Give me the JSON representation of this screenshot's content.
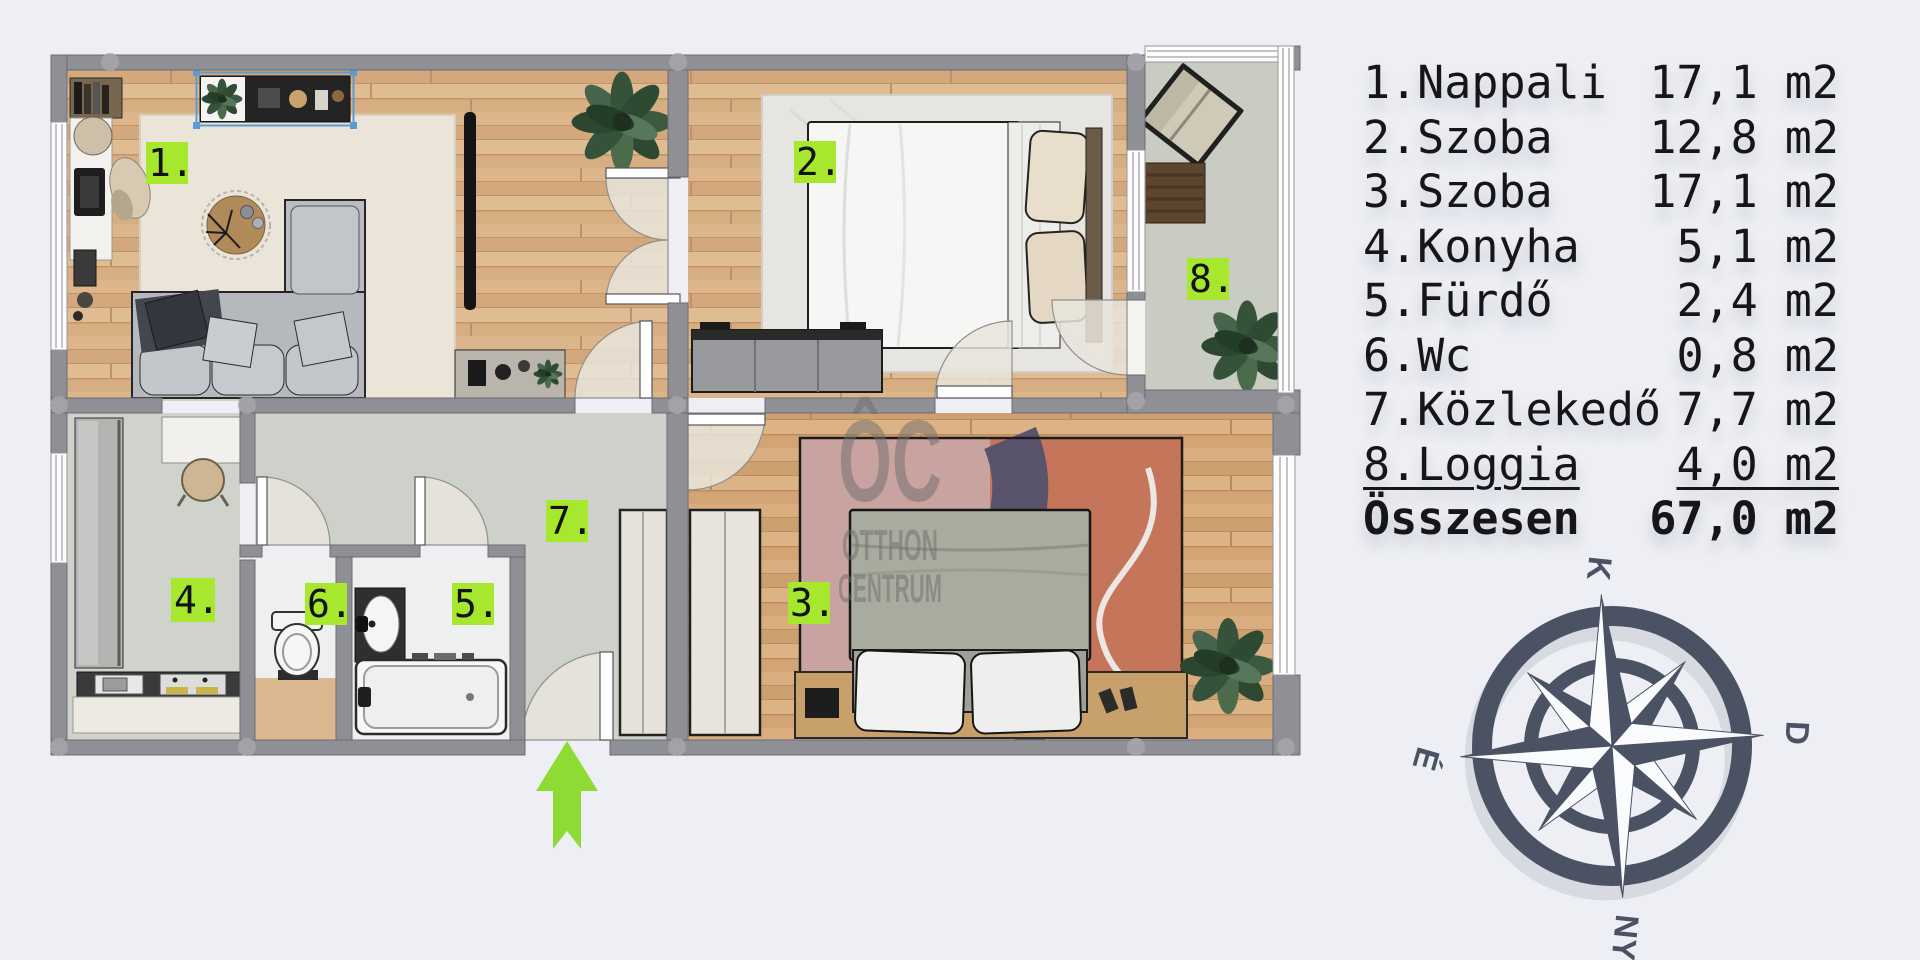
{
  "page": {
    "background": "#edeff4",
    "type": "apartment floor plan"
  },
  "legend": {
    "rows": [
      {
        "name": "1.Nappali",
        "area": "17,1 m2"
      },
      {
        "name": "2.Szoba",
        "area": "12,8 m2"
      },
      {
        "name": "3.Szoba",
        "area": "17,1 m2"
      },
      {
        "name": "4.Konyha",
        "area": "5,1 m2"
      },
      {
        "name": "5.Fürdő",
        "area": "2,4 m2"
      },
      {
        "name": "6.Wc",
        "area": "0,8 m2"
      },
      {
        "name": "7.Közlekedő",
        "area": "7,7 m2"
      },
      {
        "name": "8.Loggia",
        "area": "4,0 m2"
      },
      {
        "name": "Összesen",
        "area": "67,0 m2"
      }
    ]
  },
  "plan": {
    "labels": [
      {
        "text": "1."
      },
      {
        "text": "2."
      },
      {
        "text": "3."
      },
      {
        "text": "4."
      },
      {
        "text": "5."
      },
      {
        "text": "6."
      },
      {
        "text": "7."
      },
      {
        "text": "8."
      }
    ],
    "colors": {
      "wall": "#8f9095",
      "wood_floor": "#d7ae82",
      "grey_floor": "#cdd1ca",
      "bath_floor": "#eef0ef",
      "label_green": "#a7e82f",
      "arrow_green": "#8edc33",
      "compass": "#4b5264",
      "selection_blue": "#5b9bd5"
    }
  },
  "watermark": {
    "logo": "ÔC",
    "line1": "OTTHON",
    "line2": "CENTRUM"
  },
  "compass": {
    "top": "K",
    "right": "D",
    "bottom": "NY",
    "left": "É"
  },
  "icons": {
    "entrance": "arrow-up-icon",
    "compass": "compass-rose-icon"
  }
}
